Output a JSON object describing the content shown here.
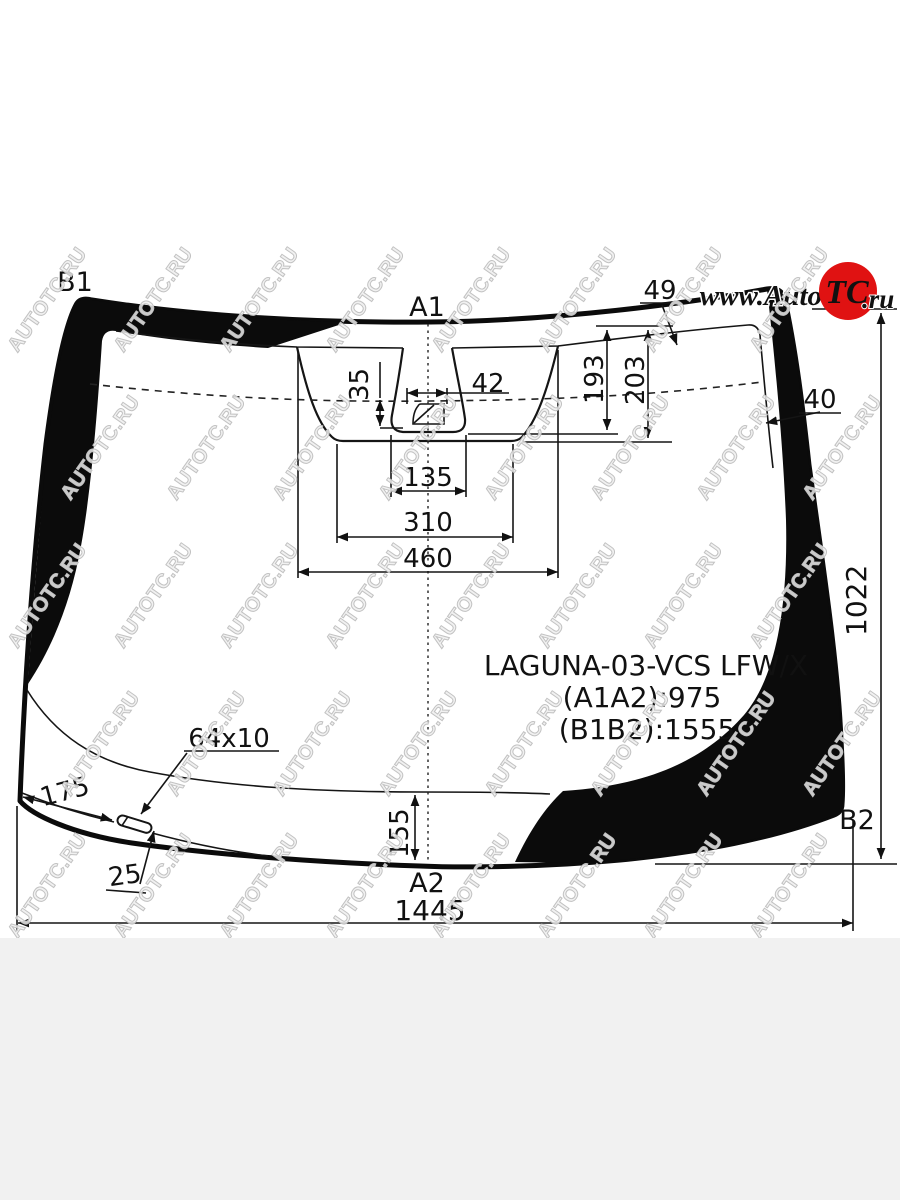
{
  "diagram": {
    "corner_labels": {
      "top_left": "B1",
      "top_center": "A1",
      "bottom_center": "A2",
      "bottom_right": "B2"
    },
    "part_info": {
      "model": "LAGUNA-03-VCS LFW/X",
      "a1a2": "(A1A2):975",
      "b1b2": "(B1B2):1555"
    },
    "dimensions": {
      "band_top_width": "49",
      "band_side_width": "40",
      "sensor_offset_height": "35",
      "sensor_width": "42",
      "camera_depth_inner": "193",
      "camera_depth_outer": "203",
      "cup_width": "135",
      "notch_bottom_width": "310",
      "notch_top_width": "460",
      "strip_size": "64x10",
      "strip_distance": "175",
      "strip_inset": "25",
      "bottom_band_height": "155",
      "glass_bottom_width": "1445",
      "glass_height": "1022"
    }
  },
  "logo": {
    "prefix": "www.Auto",
    "badge": "TC",
    "suffix": ".ru",
    "badge_color": "#e01212"
  },
  "watermark": {
    "text": "AUTOTC.RU"
  },
  "colors": {
    "line": "#0b0b0b",
    "background": "#ffffff",
    "footer": "#f1f1f1"
  }
}
